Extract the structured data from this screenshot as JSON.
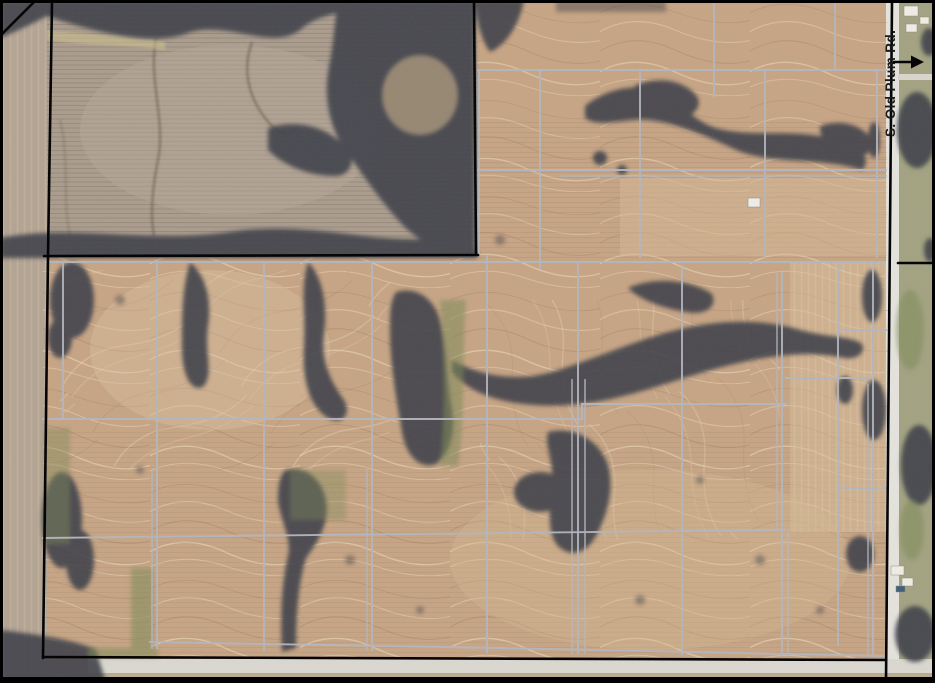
{
  "map": {
    "type": "aerial-photo-parcel-map",
    "road_label": "S. Old Plum Rd.",
    "road_arrow_direction": "east"
  },
  "colors": {
    "field_tan": "#c7a585",
    "field_gray": "#ab9d8e",
    "left_strip": "#b3a493",
    "grass_east": "#a3a382",
    "woods": "#40424c",
    "waterway_green": "#7e8a58",
    "road": "#e5e3dd",
    "road_bottom": "#dad8d0",
    "tile_line": "#b4b7bf",
    "boundary": "#000000",
    "label_text": "#151515"
  }
}
